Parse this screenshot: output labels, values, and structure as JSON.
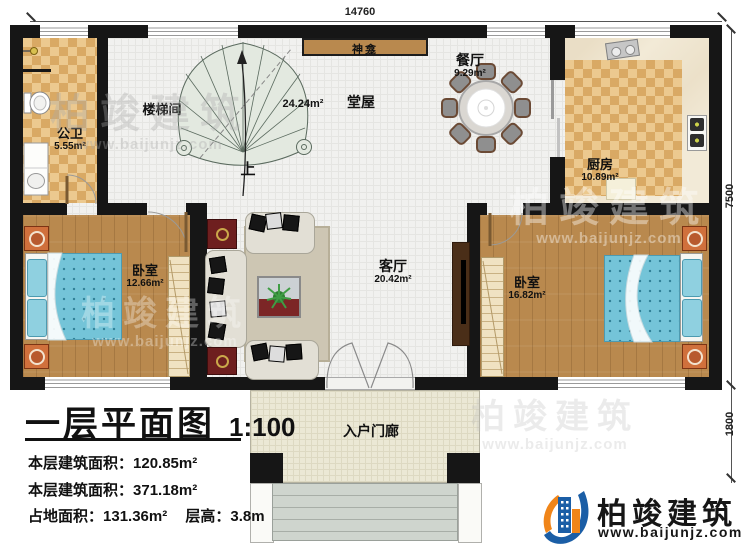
{
  "dimensions": {
    "top": "14760",
    "right_upper": "7500",
    "right_lower": "1800"
  },
  "rooms": {
    "shrine": {
      "name": "神龛"
    },
    "stairwell": {
      "name": "楼梯间",
      "direction": "上"
    },
    "hall": {
      "name": "堂屋",
      "area": "24.24m²"
    },
    "dining": {
      "name": "餐厅",
      "area": "9.29m²"
    },
    "kitchen": {
      "name": "厨房",
      "area": "10.89m²"
    },
    "bathroom": {
      "name": "公卫",
      "area": "5.55m²"
    },
    "bedroom_left": {
      "name": "卧室",
      "area": "12.66m²"
    },
    "bedroom_right": {
      "name": "卧室",
      "area": "16.82m²"
    },
    "living_room": {
      "name": "客厅",
      "area": "20.42m²"
    },
    "porch": {
      "name": "入户门廊"
    }
  },
  "title_block": {
    "title": "一层平面图",
    "scale": "1:100",
    "stats": [
      {
        "label": "本层建筑面积：",
        "value": "120.85m²"
      },
      {
        "label": "本层建筑面积：",
        "value": "371.18m²"
      },
      {
        "label": "占地面积：",
        "value": "131.36m²",
        "label2": "层高：",
        "value2": "3.8m"
      }
    ]
  },
  "brand": {
    "name": "柏竣建筑",
    "website": "www.baijunjz.com"
  },
  "watermark": {
    "name": "柏竣建筑",
    "website": "www.baijunjz.com"
  },
  "colors": {
    "wall": "#161616",
    "wood": "#b9894e",
    "checker_light": "#ecc98f",
    "checker_dark": "#d9a964",
    "bed_blue": "#74c4d8",
    "accent_red": "#6e1f1f",
    "brand_blue": "#1b5ea6",
    "brand_orange": "#f08519"
  }
}
